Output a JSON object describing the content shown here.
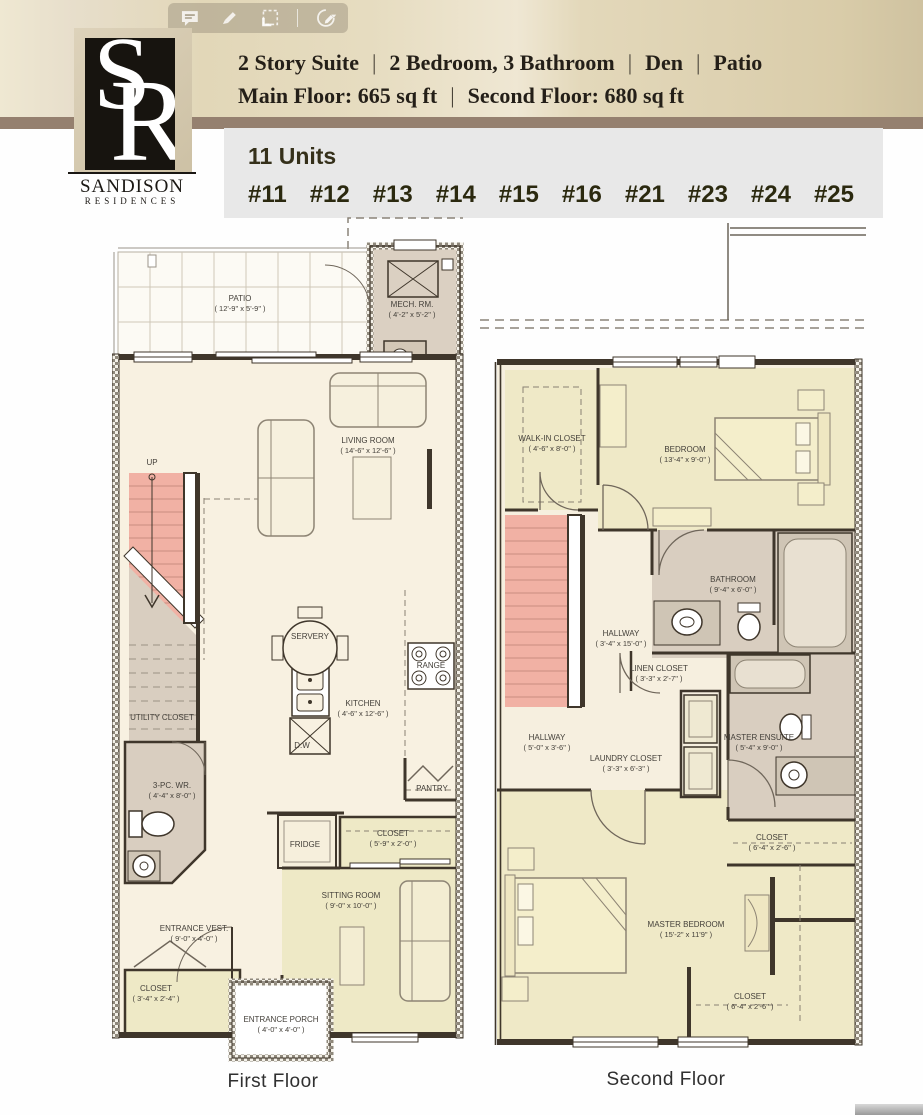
{
  "colors": {
    "tan_band": "#E4DABC",
    "brown_strip": "#95806F",
    "units_panel": "#E8E8E8",
    "floor_cream": "#F8F1E1",
    "floor_yellow": "#EEE9C6",
    "room_gray": "#D9CEC0",
    "stairs_pink": "#F1B1A4",
    "wall": "#3F362B"
  },
  "toolbar": {
    "icons": [
      "comment",
      "highlighter",
      "select-region",
      "sign"
    ]
  },
  "logo": {
    "monogram_s": "S",
    "monogram_r": "R",
    "name": "SANDISON",
    "subtitle": "RESIDENCES"
  },
  "header": {
    "separator": "|",
    "title_parts": [
      "2 Story Suite",
      "2 Bedroom, 3 Bathroom",
      "Den",
      "Patio"
    ],
    "subtitle_parts": [
      "Main Floor: 665 sq ft",
      "Second Floor: 680 sq ft"
    ]
  },
  "units": {
    "count_label": "11 Units",
    "numbers": [
      "#11",
      "#12",
      "#13",
      "#14",
      "#15",
      "#16",
      "#21",
      "#23",
      "#24",
      "#25"
    ]
  },
  "floor1": {
    "caption": "First Floor",
    "rooms": {
      "patio": {
        "name": "PATIO",
        "dim": "( 12'-9\" x 5'-9\" )"
      },
      "mech": {
        "name": "MECH. RM.",
        "dim": "( 4'-2\" x 5'-2\" )"
      },
      "living": {
        "name": "LIVING ROOM",
        "dim": "( 14'-6\" x 12'-6\" )"
      },
      "stairs": {
        "name": "UP"
      },
      "servery": {
        "name": "SERVERY"
      },
      "kitchen": {
        "name": "KITCHEN",
        "dim": "( 4'-6\" x 12'-6\" )"
      },
      "range": {
        "name": "RANGE"
      },
      "dishwasher": {
        "name": "D.W"
      },
      "pantry": {
        "name": "PANTRY"
      },
      "fridge": {
        "name": "FRIDGE"
      },
      "utility": {
        "name": "UTILITY CLOSET"
      },
      "wr": {
        "name": "3-PC. WR.",
        "dim": "( 4'-4\" x 8'-0\" )"
      },
      "closet_kitchen": {
        "name": "CLOSET",
        "dim": "( 5'-9\" x 2'-0\" )"
      },
      "sitting": {
        "name": "SITTING ROOM",
        "dim": "( 9'-0\" x 10'-0\" )"
      },
      "vestibule": {
        "name": "ENTRANCE VEST.",
        "dim": "( 9'-0\" x 4'-0\" )"
      },
      "closet_entry": {
        "name": "CLOSET",
        "dim": "( 3'-4\" x 2'-4\" )"
      },
      "porch": {
        "name": "ENTRANCE PORCH",
        "dim": "( 4'-0\" x 4'-0\" )"
      }
    }
  },
  "floor2": {
    "caption": "Second Floor",
    "rooms": {
      "walkin": {
        "name": "WALK-IN CLOSET",
        "dim": "( 4'-6\" x 8'-0\" )"
      },
      "bedroom": {
        "name": "BEDROOM",
        "dim": "( 13'-4\" x 9'-0\" )"
      },
      "bathroom": {
        "name": "BATHROOM",
        "dim": "( 9'-4\" x 6'-0\" )"
      },
      "hallway_upper": {
        "name": "HALLWAY",
        "dim": "( 3'-4\" x 15'-0\" )"
      },
      "linen": {
        "name": "LINEN CLOSET",
        "dim": "( 3'-3\" x 2'-7\" )"
      },
      "hallway_lower": {
        "name": "HALLWAY",
        "dim": "( 5'-0\" x 3'-6\" )"
      },
      "laundry": {
        "name": "LAUNDRY CLOSET",
        "dim": "( 3'-3\" x 6'-3\" )"
      },
      "ensuite": {
        "name": "MASTER ENSUITE",
        "dim": "( 5'-4\" x 9'-0\" )"
      },
      "closet_upper": {
        "name": "CLOSET",
        "dim": "( 6'-4\" x 2'-6\" )"
      },
      "master": {
        "name": "MASTER BEDROOM",
        "dim": "( 15'-2\" x 11'9\" )"
      },
      "closet_lower": {
        "name": "CLOSET",
        "dim": "( 6'-4\" x 2'-6\" )"
      }
    }
  }
}
